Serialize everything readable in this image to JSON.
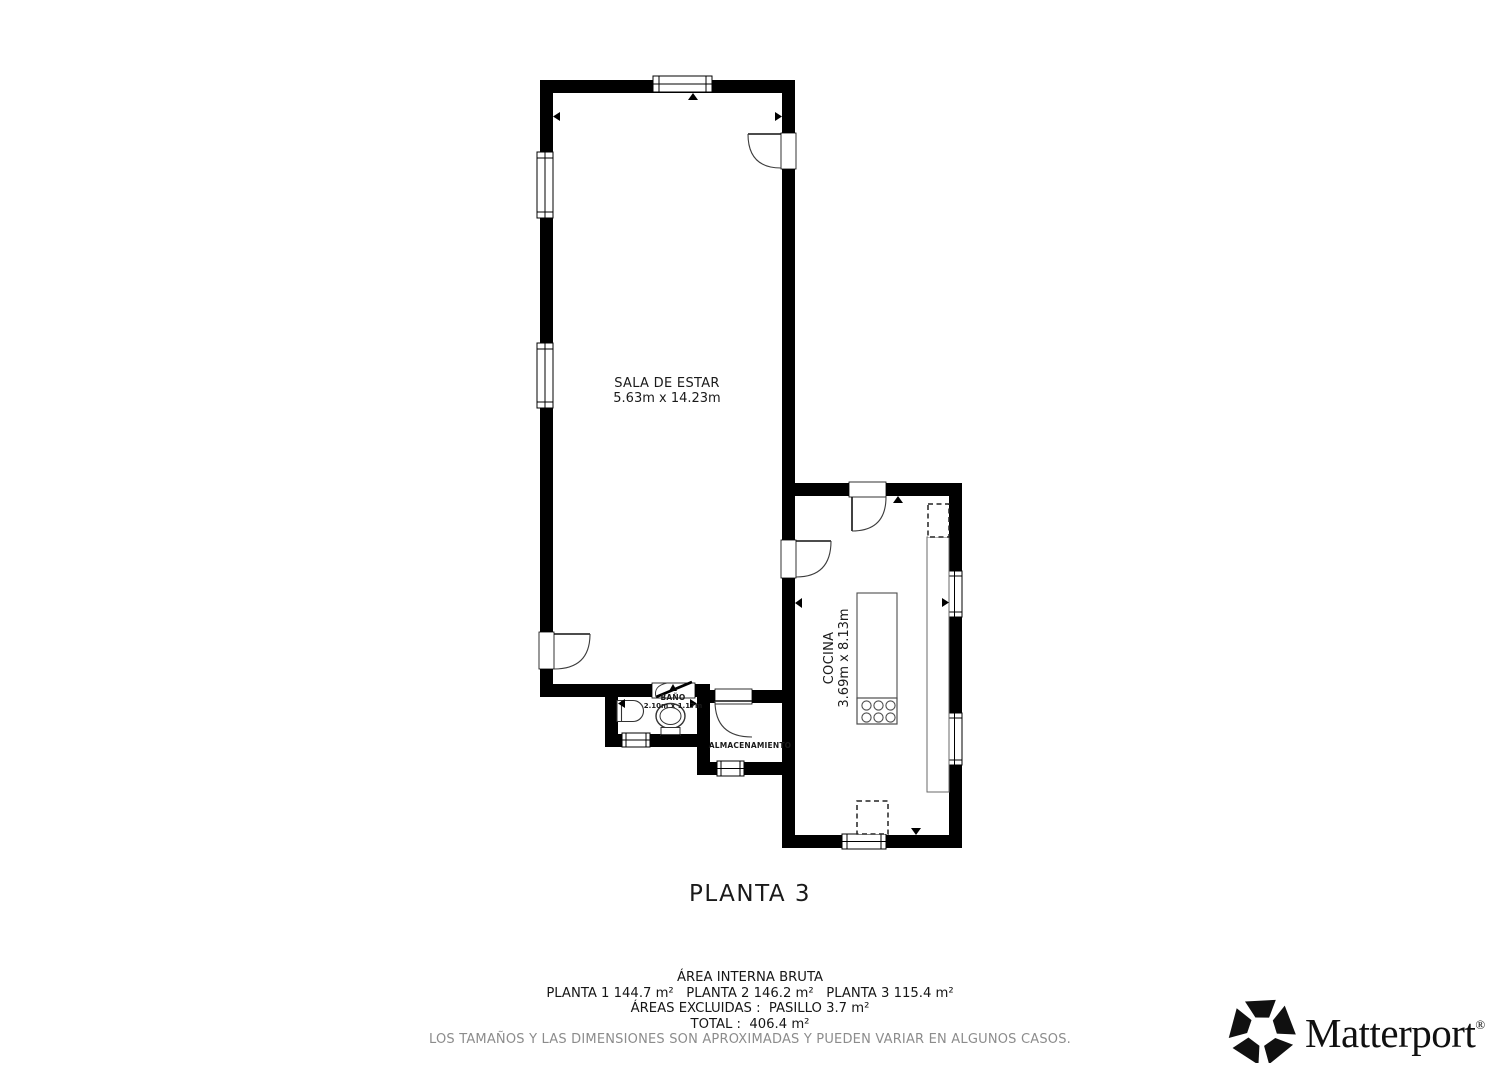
{
  "plan": {
    "floor_label": "PLANTA 3",
    "rooms": [
      {
        "name": "SALA DE ESTAR",
        "dimensions": "5.63m x 14.23m"
      },
      {
        "name": "COCINA",
        "dimensions": "3.69m x 8.13m"
      },
      {
        "name": "BAÑO",
        "dimensions": "2.10m x 1.17m"
      },
      {
        "name": "ALMACENAMIENTO",
        "dimensions": ""
      }
    ]
  },
  "summary": {
    "title": "ÁREA INTERNA BRUTA",
    "floors_line": "PLANTA 1 144.7 m²   PLANTA 2 146.2 m²   PLANTA 3 115.4 m²",
    "excluded_line": "ÁREAS EXCLUIDAS :  PASILLO 3.7 m²",
    "total_line": "TOTAL :  406.4 m²",
    "disclaimer": "LOS TAMAÑOS Y LAS DIMENSIONES SON APROXIMADAS Y PUEDEN VARIAR EN ALGUNOS CASOS.",
    "areas": {
      "planta_1": "144.7 m²",
      "planta_2": "146.2 m²",
      "planta_3": "115.4 m²",
      "excluded_pasillo": "3.7 m²",
      "total": "406.4 m²"
    }
  },
  "branding": {
    "logo_text": "Matterport",
    "registered_mark": "®"
  },
  "colors": {
    "wall": "#000000",
    "text": "#1a1a1a",
    "disclaimer_text": "#8c8c8c",
    "fixture_stroke": "#4d4d4d"
  }
}
